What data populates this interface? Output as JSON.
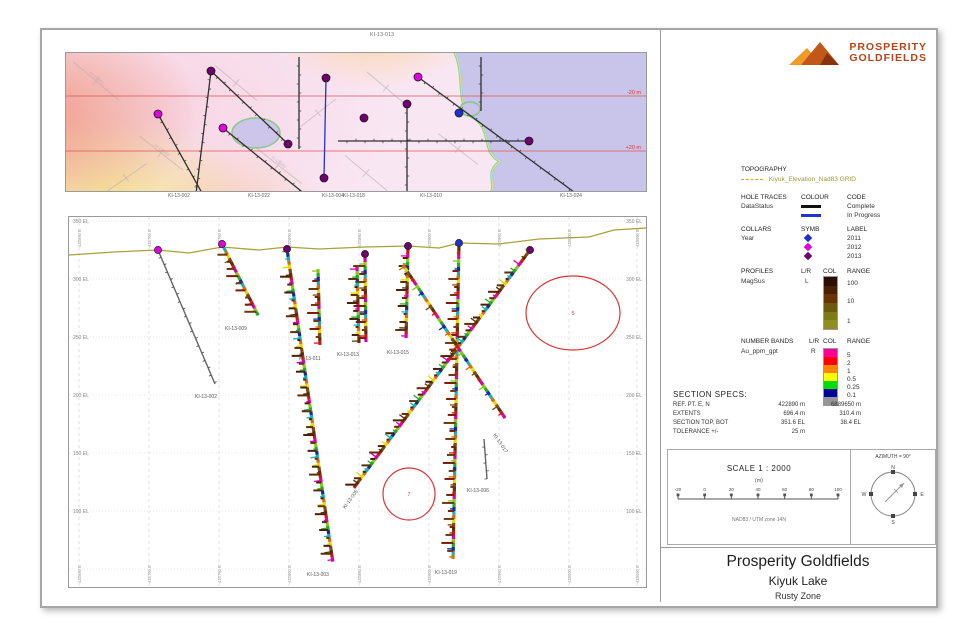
{
  "logo": {
    "line1": "PROSPERITY",
    "line2": "GOLDFIELDS",
    "color": "#b5441c"
  },
  "map": {
    "top_label": "KI-13-013",
    "bottom_labels": [
      {
        "x": 126,
        "t": "KI-13-002"
      },
      {
        "x": 206,
        "t": "KI-13-022"
      },
      {
        "x": 280,
        "t": "KI-13-004"
      },
      {
        "x": 301,
        "t": "KI-13-018"
      },
      {
        "x": 378,
        "t": "KI-13-010"
      },
      {
        "x": 518,
        "t": "KI-13-024"
      }
    ],
    "red_lines": [
      {
        "y": 43,
        "label": "-20 m"
      },
      {
        "y": 98,
        "label": "+20 m"
      }
    ],
    "red_color": "#dd3333",
    "lake": {
      "path": "M 382,-8 L 590,-8 L 590,146 L 420,146 C 438,132 415,122 436,108 C 414,100 430,74 404,62 C 390,46 402,18 386,-8 Z",
      "fill": "#c9c4ea",
      "fringe1": "#7ec87e",
      "fringe2": "#eeee66",
      "blobs": [
        {
          "cx": 190,
          "cy": 80,
          "rx": 24,
          "ry": 15
        },
        {
          "cx": 404,
          "cy": 56,
          "rx": 10,
          "ry": 7
        }
      ]
    },
    "bg_traces": [
      {
        "x": 30,
        "y": 28,
        "len": 60,
        "a": 40,
        "t": "KI-12-001"
      },
      {
        "x": 95,
        "y": 100,
        "len": 55,
        "a": 38,
        "t": "KI-12-003"
      },
      {
        "x": 60,
        "y": 125,
        "len": 50,
        "a": -35,
        "t": ""
      },
      {
        "x": 170,
        "y": 30,
        "len": 55,
        "a": 40,
        "t": ""
      },
      {
        "x": 212,
        "y": 112,
        "len": 60,
        "a": 38,
        "t": "KI-12-005"
      },
      {
        "x": 252,
        "y": 60,
        "len": 45,
        "a": -38,
        "t": ""
      },
      {
        "x": 320,
        "y": 35,
        "len": 50,
        "a": 40,
        "t": ""
      },
      {
        "x": 300,
        "y": 120,
        "len": 55,
        "a": 40,
        "t": ""
      },
      {
        "x": 392,
        "y": 96,
        "len": 50,
        "a": 38,
        "t": ""
      },
      {
        "x": 432,
        "y": 28,
        "len": 45,
        "a": 40,
        "t": ""
      },
      {
        "x": 472,
        "y": 120,
        "len": 60,
        "a": -35,
        "t": "KI-12-009"
      },
      {
        "x": 506,
        "y": 40,
        "len": 55,
        "a": 40,
        "t": "KI-12-011"
      },
      {
        "x": 548,
        "y": 92,
        "len": 60,
        "a": 38,
        "t": ""
      },
      {
        "x": 522,
        "y": 14,
        "len": 40,
        "a": 40,
        "t": ""
      }
    ],
    "traces": [
      {
        "x1": 145,
        "y1": 18,
        "x2": 130,
        "y2": 141,
        "c": "#303030",
        "ticks": true
      },
      {
        "x1": 145,
        "y1": 18,
        "x2": 222,
        "y2": 91,
        "c": "#303030",
        "ticks": true
      },
      {
        "x1": 92,
        "y1": 61,
        "x2": 136,
        "y2": 140,
        "c": "#303030",
        "ticks": true
      },
      {
        "x1": 157,
        "y1": 75,
        "x2": 240,
        "y2": 142,
        "c": "#303030",
        "ticks": true
      },
      {
        "x1": 233,
        "y1": 4,
        "x2": 233,
        "y2": 96,
        "c": "#303030",
        "ticks": true
      },
      {
        "x1": 260,
        "y1": 25,
        "x2": 258,
        "y2": 125,
        "c": "#2233cc",
        "ticks": false
      },
      {
        "x1": 352,
        "y1": 24,
        "x2": 512,
        "y2": 142,
        "c": "#303030",
        "ticks": true
      },
      {
        "x1": 341,
        "y1": 51,
        "x2": 341,
        "y2": 142,
        "c": "#303030",
        "ticks": true
      },
      {
        "x1": 415,
        "y1": 4,
        "x2": 415,
        "y2": 58,
        "c": "#303030",
        "ticks": true
      },
      {
        "x1": 272,
        "y1": 88,
        "x2": 463,
        "y2": 88,
        "c": "#303030",
        "ticks": true
      }
    ],
    "collars": [
      {
        "x": 145,
        "y": 18,
        "c": "#700070"
      },
      {
        "x": 222,
        "y": 91,
        "c": "#700070"
      },
      {
        "x": 92,
        "y": 61,
        "c": "#e000e0"
      },
      {
        "x": 157,
        "y": 75,
        "c": "#e000e0"
      },
      {
        "x": 260,
        "y": 25,
        "c": "#700070"
      },
      {
        "x": 258,
        "y": 125,
        "c": "#700070"
      },
      {
        "x": 352,
        "y": 24,
        "c": "#e000e0"
      },
      {
        "x": 393,
        "y": 60,
        "c": "#2030d0"
      },
      {
        "x": 298,
        "y": 65,
        "c": "#700070"
      },
      {
        "x": 341,
        "y": 51,
        "c": "#700070"
      },
      {
        "x": 463,
        "y": 88,
        "c": "#700070"
      }
    ]
  },
  "section": {
    "grid": {
      "vx": [
        10,
        80,
        150,
        220,
        290,
        360,
        430,
        500,
        568
      ],
      "hy": [
        4,
        62,
        120,
        178,
        236,
        294,
        352
      ]
    },
    "elev_labels": [
      "350 EL",
      "300 EL",
      "250 EL",
      "200 EL",
      "150 EL",
      "100 EL"
    ],
    "coord_labels": [
      "422650 E",
      "422700 E",
      "422750 E",
      "422800 E",
      "422850 E",
      "422900 E",
      "422950 E",
      "423000 E",
      "423050 E"
    ],
    "topo": "0,38 45,35 89,33 120,36 153,30 190,33 218,30 250,32 296,30 339,29 370,31 390,26 430,27 470,22 520,20 545,13 577,11",
    "topo_color": "#a8a23a",
    "holes": [
      {
        "x1": 89,
        "y1": 33,
        "x2": 146,
        "y2": 167,
        "type": "gray",
        "collar": "#e000e0",
        "label": "KI-13-002",
        "lx": 126,
        "ly": 181,
        "seed": 1
      },
      {
        "x1": 153,
        "y1": 27,
        "x2": 190,
        "y2": 100,
        "type": "assay",
        "profile": true,
        "collar": "#e000e0",
        "label": "KI-13-009",
        "lx": 156,
        "ly": 113,
        "seed": 2
      },
      {
        "x1": 218,
        "y1": 32,
        "x2": 264,
        "y2": 346,
        "type": "assay",
        "profile": true,
        "collar": "#700070",
        "label": "KI-13-003",
        "lx": 238,
        "ly": 359,
        "seed": 3
      },
      {
        "x1": 249,
        "y1": 52,
        "x2": 251,
        "y2": 130,
        "type": "assay",
        "profile": true,
        "label": "KI-13-011",
        "lx": 230,
        "ly": 143,
        "seed": 4
      },
      {
        "x1": 288,
        "y1": 50,
        "x2": 290,
        "y2": 126,
        "type": "assay",
        "profile": true,
        "label": "KI-13-013",
        "lx": 268,
        "ly": 139,
        "seed": 5
      },
      {
        "x1": 296,
        "y1": 37,
        "x2": 297,
        "y2": 128,
        "type": "assay",
        "profile": true,
        "collar": "#700070",
        "seed": 6
      },
      {
        "x1": 339,
        "y1": 29,
        "x2": 337,
        "y2": 124,
        "type": "assay",
        "profile": true,
        "collar": "#700070",
        "label": "KI-13-015",
        "lx": 318,
        "ly": 137,
        "seed": 7
      },
      {
        "x1": 390,
        "y1": 26,
        "x2": 384,
        "y2": 344,
        "type": "assay",
        "profile": true,
        "collar": "#2030d0",
        "label": "KI-13-019",
        "lx": 366,
        "ly": 357,
        "seed": 8
      },
      {
        "x1": 461,
        "y1": 33,
        "x2": 284,
        "y2": 272,
        "type": "assay",
        "profile": true,
        "collar": "#700070",
        "label": "KI-13-005",
        "lx": 276,
        "ly": 292,
        "rot": -53,
        "seed": 9
      },
      {
        "x1": 334,
        "y1": 48,
        "x2": 438,
        "y2": 204,
        "type": "assay",
        "label": "KI-13-017",
        "lx": 424,
        "ly": 218,
        "rot": 56,
        "seed": 10
      },
      {
        "x1": 415,
        "y1": 222,
        "x2": 418,
        "y2": 262,
        "type": "gray",
        "label": "KI-13-006",
        "lx": 398,
        "ly": 275,
        "seed": 11
      }
    ],
    "annotations": [
      {
        "shape": "ellipse",
        "cx": 504,
        "cy": 96,
        "rx": 47,
        "ry": 37,
        "t": "5"
      },
      {
        "shape": "circle",
        "cx": 340,
        "cy": 277,
        "r": 26,
        "t": "7"
      }
    ],
    "annotation_color": "#dd3333",
    "assay_palette": [
      "#d86c10",
      "#28a828",
      "#cc1818",
      "#e6d800",
      "#1828a0",
      "#d800b0",
      "#804810",
      "#18b0b0",
      "#88c818",
      "#5a2e08"
    ],
    "profile_colors": [
      "#5a2e08",
      "#6b3a0c",
      "#4a2004",
      "#7a1c04"
    ]
  },
  "legend": {
    "topography": {
      "title": "TOPOGRAPHY",
      "label": "Kiyuk_Elevation_Nad83 GRID",
      "color": "#a8a23a"
    },
    "hole_traces": {
      "title": "HOLE TRACES",
      "col1": "COLOUR",
      "col2": "CODE",
      "group": "DataStatus",
      "items": [
        {
          "code": "Complete",
          "color": "#111111"
        },
        {
          "code": "In Progress",
          "color": "#2233cc"
        }
      ]
    },
    "collars": {
      "title": "COLLARS",
      "col1": "SYMB",
      "col2": "LABEL",
      "group": "Year",
      "items": [
        {
          "label": "2011",
          "color": "#2030d0"
        },
        {
          "label": "2012",
          "color": "#e000e0"
        },
        {
          "label": "2013",
          "color": "#700070"
        }
      ]
    },
    "profiles": {
      "title": "PROFILES",
      "col0": "L/R",
      "col1": "COL",
      "col2": "RANGE",
      "name": "MagSus",
      "lr": "L",
      "colors": [
        "#2a0e02",
        "#4a2004",
        "#6a3406",
        "#6e5a0e",
        "#7c7c16",
        "#8e8e24"
      ],
      "ranges": [
        "100",
        "10",
        "1"
      ]
    },
    "number_bands": {
      "title": "NUMBER BANDS",
      "col0": "L/R",
      "col1": "COL",
      "col2": "RANGE",
      "name": "Au_ppm_gpt",
      "lr": "R",
      "colors": [
        "#ff0096",
        "#ff0000",
        "#ff8400",
        "#ffff00",
        "#00dd00",
        "#000096",
        "#969696"
      ],
      "ranges": [
        "5",
        "2",
        "1",
        "0.5",
        "0.25",
        "0.1"
      ]
    }
  },
  "section_specs": {
    "title": "SECTION  SPECS:",
    "rows": [
      {
        "k": "REF. PT.  E, N",
        "v1": "422890 m",
        "v2": "6889650 m"
      },
      {
        "k": "EXTENTS",
        "v1": "696.4 m",
        "v2": "310.4 m"
      },
      {
        "k": "SECTION TOP, BOT",
        "v1": "351.6 EL",
        "v2": "38.4 EL"
      },
      {
        "k": "TOLERANCE  +/-",
        "v1": "25 m",
        "v2": ""
      }
    ]
  },
  "scale": {
    "label": "SCALE  1 : 2000",
    "unit": "(m)",
    "ticks": [
      "-20",
      "0",
      "20",
      "40",
      "60",
      "80",
      "100"
    ],
    "datum": "NAD83 / UTM zone 14N"
  },
  "compass": {
    "label": "AZIMUTH = 90°",
    "n": "N",
    "e": "E",
    "s": "S",
    "w": "W"
  },
  "title_block": {
    "company": "Prosperity Goldfields",
    "project": "Kiyuk Lake",
    "section": "Rusty Zone"
  }
}
